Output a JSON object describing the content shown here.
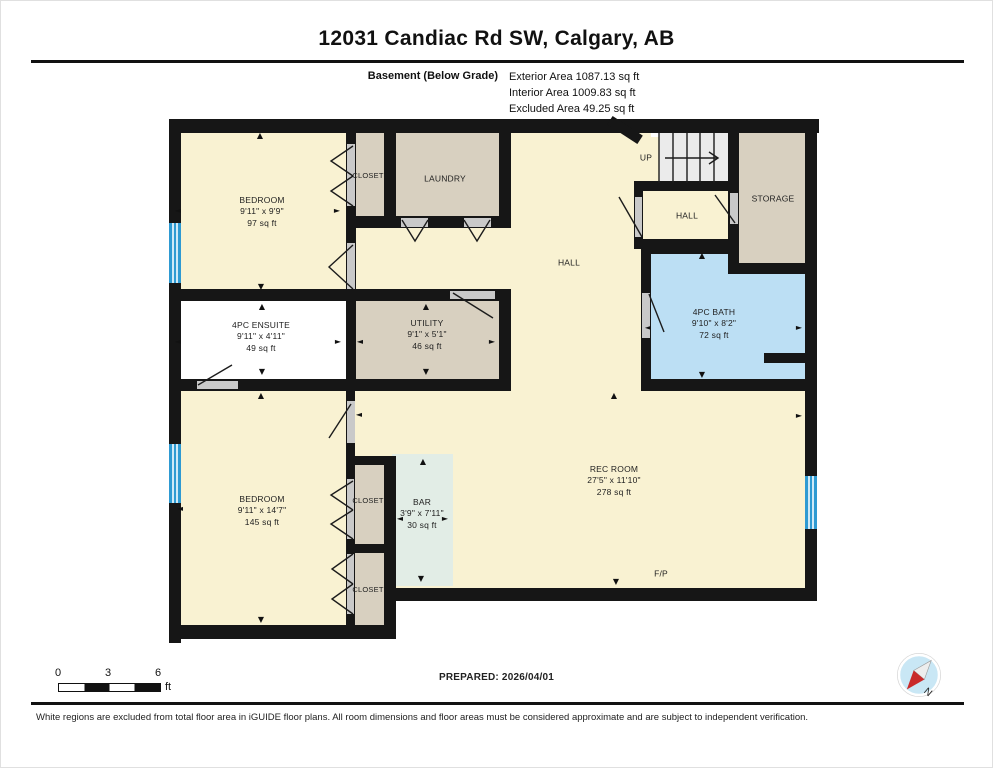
{
  "title": "12031 Candiac Rd SW, Calgary, AB",
  "floor": {
    "name": "Basement (Below Grade)",
    "exterior_area": "Exterior Area 1087.13 sq ft",
    "interior_area": "Interior Area 1009.83 sq ft",
    "excluded_area": "Excluded Area 49.25 sq ft"
  },
  "rooms": {
    "bedroom1": {
      "name": "BEDROOM",
      "dims": "9'11\" x 9'9\"",
      "area": "97 sq ft"
    },
    "closet_top": {
      "name": "CLOSET"
    },
    "laundry": {
      "name": "LAUNDRY"
    },
    "hall_main": {
      "name": "HALL"
    },
    "stairs": {
      "name": "UP"
    },
    "hall_small": {
      "name": "HALL"
    },
    "storage": {
      "name": "STORAGE"
    },
    "bath": {
      "name": "4PC BATH",
      "dims": "9'10\" x 8'2\"",
      "area": "72 sq ft"
    },
    "ensuite": {
      "name": "4PC ENSUITE",
      "dims": "9'11\" x 4'11\"",
      "area": "49 sq ft"
    },
    "utility": {
      "name": "UTILITY",
      "dims": "9'1\" x 5'1\"",
      "area": "46 sq ft"
    },
    "bedroom2": {
      "name": "BEDROOM",
      "dims": "9'11\" x 14'7\"",
      "area": "145 sq ft"
    },
    "closet_mid": {
      "name": "CLOSET"
    },
    "closet_bottom": {
      "name": "CLOSET"
    },
    "bar": {
      "name": "BAR",
      "dims": "3'9\" x 7'11\"",
      "area": "30 sq ft"
    },
    "rec_room": {
      "name": "REC ROOM",
      "dims": "27'5\" x 11'10\"",
      "area": "278 sq ft"
    },
    "fireplace": {
      "name": "F/P"
    }
  },
  "icons": {
    "dim_up": "▲",
    "dim_down": "▼",
    "dim_left": "◄",
    "dim_right": "►"
  },
  "scale": {
    "t0": "0",
    "t3": "3",
    "t6": "6",
    "unit": "ft"
  },
  "prepared": "PREPARED: 2026/04/01",
  "compass": {
    "label": "N"
  },
  "disclaimer": "White regions are excluded from total floor area in iGUIDE floor plans. All room dimensions and floor areas must be considered approximate and are subject to independent verification.",
  "colors": {
    "room_cream": "#f9f2d2",
    "room_beige": "#d8d0c0",
    "room_excluded_white": "#ffffff",
    "bath_blue": "#bcdff4",
    "bar_teal": "#e2ede6",
    "wall_black": "#161616",
    "window_blue": "#2e9ad2",
    "compass_red": "#c92a2a"
  }
}
